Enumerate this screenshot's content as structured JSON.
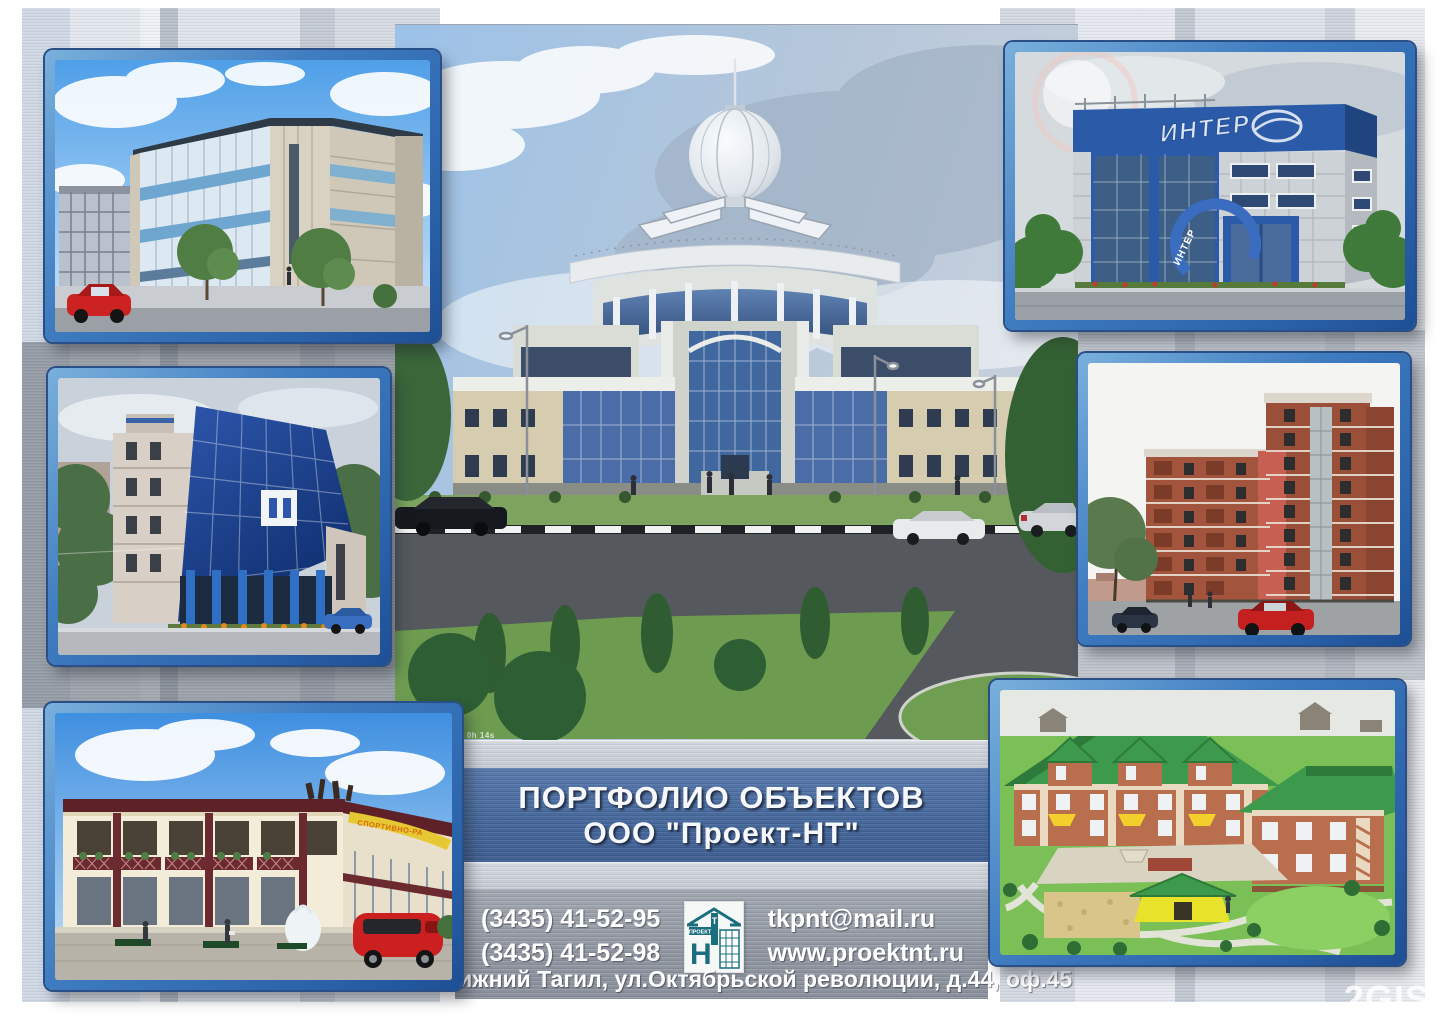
{
  "poster": {
    "banner": {
      "line1": "ПОРТФОЛИО ОБЪЕКТОВ",
      "line2": "ООО \"Проект-НТ\""
    },
    "contacts": {
      "phone1": "(3435) 41-52-95",
      "phone2": "(3435) 41-52-98",
      "email": "tkpnt@mail.ru",
      "website": "www.proektnt.ru",
      "address": "г.Нижний Тагил, ул.Октябрьской революции, д.44, оф.45"
    },
    "logo": {
      "word": "ПРОЕКТ",
      "letter_n": "Н",
      "letter_t": "Т"
    },
    "watermark": "2GIS",
    "render_stamp": "in hr30p 0h 14s"
  },
  "signs": {
    "inter_roof": "ИНТЕР",
    "inter_entrance": "ИНТЕР",
    "sport_center": "СПОРТИВНО-РА"
  },
  "colors": {
    "frame_blue": "#2f6cb0",
    "banner_blue": "#47699c",
    "panel_gray": "#8f95a0",
    "strip_gray": "#c9cdd5",
    "logo_teal": "#1b6e7e",
    "roof_green": "#3d9a4d",
    "brick_red": "#9c4f38"
  }
}
